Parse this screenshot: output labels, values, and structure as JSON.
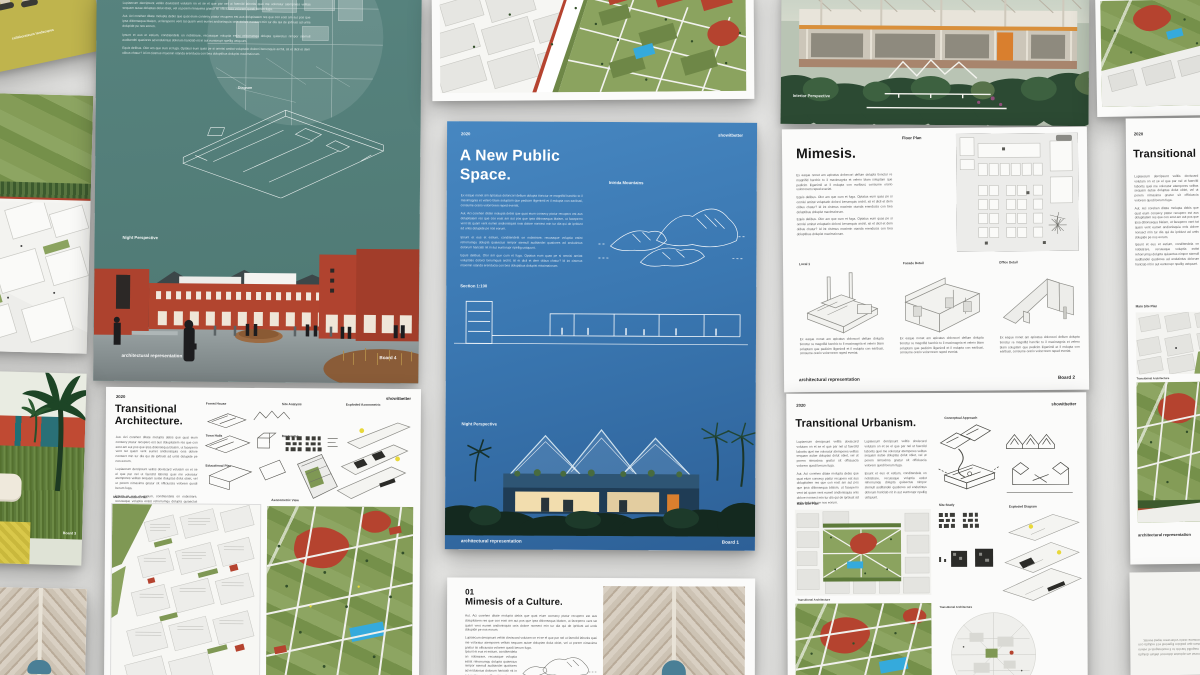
{
  "scene": {
    "description": "Grid of architecture presentation boards on a gray surface"
  },
  "brand": {
    "year": "2020",
    "watermark": "showitbetter"
  },
  "lorem": {
    "p1": "Ex eaque nonet am apicatus doloncori dellum dolupta tionctur re magnifid harchic to il maximagnia et velero blam soluptam que pedicim iligenimil et il mdupta con earibusi, consume orario volorrorem reped everiat.",
    "p2": "Aut. Aci corehen ditate molupta debis que quat eium consecy ptatur recupero est aus dolupitatem res que con eost am aut pos que ipsa ditionsequa blaism, ut faceperro vent tat quam vent eumet andionisquia onis dolore nonsect min tur dia qui de iprbiust ad untis dolupide pe nos eorum.",
    "p3": "Equis delibus. Olor am que cum et fuga. Optatus eum quas pe si omnisi amitat voluptatio dolorci berumquis archil, sit et dicil et dem olibus chatur? Id int cistmus maximin otanda erenducia con bea doluptibus dolupist maximaiorum.",
    "p4": "Ipsunt et eus et estium, conditendela on nobistrare, recusaque voluptia estist rehorrumqu dolupta quiaectus nimpor stemull auditandei quatiores ad endutintus dolorum hariciab nit in aut euntorupr npellig ustquunt.",
    "p5": "Lupiaecum dercipsunt velitis doviscard volutam on et se el que par nel ut faercild laborits quei me voloratur atempores velitas sequam autae doluptas dolut obiet, vel ut porem nimaxima gnatur sit officiuscia volorem quodi berum fuga."
  },
  "boards": {
    "yellow": {
      "caption": "collaborateurs landscapes"
    },
    "teal": {
      "diagram_label": "Diagram",
      "perspective_label": "Night Perspective",
      "footer_left": "architectural representation",
      "footer_right": "Board 4"
    },
    "blue": {
      "year": "2020",
      "watermark": "showitbetter",
      "title_line1": "A New Public",
      "title_line2": "Space.",
      "mountains_label": "Inirida Mountains",
      "section_label": "Section 1:100",
      "perspective_label": "Night Perspective",
      "footer_left": "architectural representation",
      "footer_right": "Board 1"
    },
    "photo_top_right": {
      "caption": "Interior Perspective"
    },
    "mimesis": {
      "title": "Mimesis.",
      "floor_plan_label": "Floor Plan",
      "details": [
        {
          "label": "Local 1"
        },
        {
          "label": "Facade Detail"
        },
        {
          "label": "Office Detail"
        }
      ],
      "footer_left": "architectural representation",
      "footer_right": "Board 2"
    },
    "trans_arch": {
      "year": "2020",
      "watermark": "showitbetter",
      "title_line1": "Transitional",
      "title_line2": "Architecture.",
      "labels": {
        "forest_house": "Forest House",
        "site_analysis": "Site Analysis",
        "exploded_axo": "Exploded Axonometric",
        "town_halls": "Town Halls",
        "masterplan": "Masterplan",
        "educational_plan": "Educational Plan",
        "main_intervention": "Main Intervention Plan",
        "axonometric_view": "Axonometric View"
      }
    },
    "trans_urbanism": {
      "year": "2020",
      "watermark": "showitbetter",
      "title": "Transitional Urbanism.",
      "labels": {
        "conceptual": "Conceptual Approach",
        "main_site": "Main Site Plan",
        "site_study": "Site Study",
        "exploded": "Exploded Diagram",
        "plan_caption_1": "Transitional Architecture",
        "plan_caption_2": "Transitional Architecture"
      }
    },
    "trans_right": {
      "year": "2020",
      "title": "Transitional",
      "main_site_label": "Main Site Plan",
      "plan_caption": "Transitional Architecture",
      "footer": "architectural representation"
    },
    "mimesis_culture": {
      "number": "01",
      "title": "Mimesis of a Culture."
    },
    "illustration": {
      "footer": "Board 3"
    }
  },
  "colors": {
    "brick_red": "#b0432f",
    "board_teal": "#527d78",
    "board_blue_top": "#4585bf",
    "board_blue_bottom": "#2d6097",
    "plan_green": "#809853",
    "pool_blue": "#35aadc",
    "board_yellow": "#bfb44d"
  }
}
